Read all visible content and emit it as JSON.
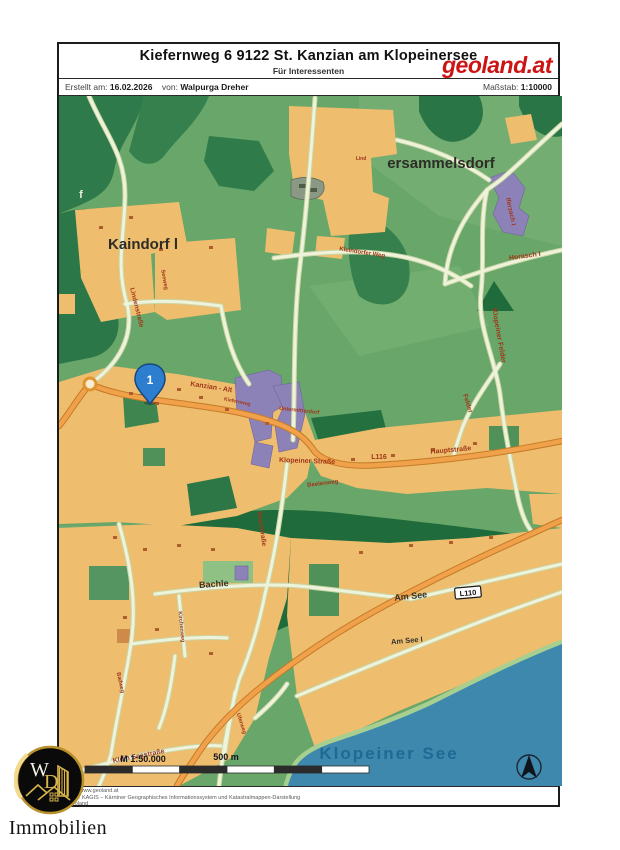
{
  "page": {
    "header": {
      "title": "Kiefernweg 6 9122 St. Kanzian am Klopeinersee",
      "subtitle": "Für Interessenten",
      "logo": "geoland.at",
      "created_label": "Erstellt am:",
      "created_value": "16.02.2026",
      "by_label": "von:",
      "by_value": "Walpurga Dreher",
      "scale_label": "Maßstab:",
      "scale_value": "1:10000"
    },
    "footer": {
      "lines": [
        "https://www.geoland.at",
        "Quelle: KAGIS – Kärntner Geographisches Informationssystem und Katastralmappen-Darstellung",
        "© geoland"
      ]
    },
    "branding": {
      "initial_w": "W",
      "initial_d": "D",
      "name": "Immobilien"
    }
  },
  "map": {
    "marker": {
      "label": "1"
    },
    "shield": "L110",
    "scalebar": {
      "ratio": "M 1:50.000",
      "distance": "500 m"
    },
    "colors": {
      "base_green": "#68a66a",
      "forest_dark": "#1f6b3c",
      "settlement_orange": "#eebd6e",
      "building_purple": "#8d82b8",
      "road_orange": "#f0a14a",
      "road_pale": "#eef3da",
      "lake_blue": "#3e88ae",
      "label_red": "#a0371a",
      "brand_red": "#cc1414",
      "marker_blue": "#2e7ed0"
    },
    "labels": [
      {
        "text": "Lind",
        "x": 302,
        "y": 64,
        "rot": 0,
        "size": 5,
        "cls": "lbl-road"
      },
      {
        "text": "ersammelsdorf",
        "x": 382,
        "y": 72,
        "rot": 0,
        "size": 15,
        "cls": "lbl-place"
      },
      {
        "text": "Kaindorf l",
        "x": 84,
        "y": 153,
        "rot": 0,
        "size": 15,
        "cls": "lbl-place"
      },
      {
        "text": "f",
        "x": 22,
        "y": 102,
        "rot": 0,
        "size": 11,
        "cls": "lbl-light"
      },
      {
        "text": "Kanzian - Alt",
        "x": 152,
        "y": 293,
        "rot": 9,
        "size": 7,
        "cls": "lbl-road"
      },
      {
        "text": "Kiefernweg",
        "x": 178,
        "y": 307,
        "rot": 12,
        "size": 5,
        "cls": "lbl-road"
      },
      {
        "text": "Untermitterdorf",
        "x": 240,
        "y": 316,
        "rot": 6,
        "size": 5.5,
        "cls": "lbl-road"
      },
      {
        "text": "Klopeiner Straße",
        "x": 248,
        "y": 367,
        "rot": 2,
        "size": 7,
        "cls": "lbl-road"
      },
      {
        "text": "L116",
        "x": 320,
        "y": 363,
        "rot": 0,
        "size": 7,
        "cls": "lbl-road"
      },
      {
        "text": "Hauptstraße",
        "x": 392,
        "y": 356,
        "rot": -5,
        "size": 7,
        "cls": "lbl-road"
      },
      {
        "text": "Beelenweg",
        "x": 264,
        "y": 389,
        "rot": -7,
        "size": 6,
        "cls": "lbl-road"
      },
      {
        "text": "Kleindorfer Weg",
        "x": 303,
        "y": 158,
        "rot": 9,
        "size": 6,
        "cls": "lbl-road"
      },
      {
        "text": "Lindenstraße",
        "x": 76,
        "y": 212,
        "rot": 76,
        "size": 6.5,
        "cls": "lbl-road"
      },
      {
        "text": "Seeweg",
        "x": 104,
        "y": 184,
        "rot": 80,
        "size": 5.5,
        "cls": "lbl-road"
      },
      {
        "text": "Iferzach I",
        "x": 450,
        "y": 116,
        "rot": 78,
        "size": 6.5,
        "cls": "lbl-road"
      },
      {
        "text": "Horasch I",
        "x": 466,
        "y": 162,
        "rot": -8,
        "size": 7,
        "cls": "lbl-road"
      },
      {
        "text": "Klopeiner Felder",
        "x": 438,
        "y": 240,
        "rot": 80,
        "size": 7,
        "cls": "lbl-road"
      },
      {
        "text": "Felder",
        "x": 407,
        "y": 308,
        "rot": 72,
        "size": 6.5,
        "cls": "lbl-road"
      },
      {
        "text": "Seenstraße",
        "x": 201,
        "y": 433,
        "rot": 82,
        "size": 6.5,
        "cls": "lbl-road"
      },
      {
        "text": "Bachle",
        "x": 155,
        "y": 491,
        "rot": -4,
        "size": 9,
        "cls": "lbl-place-sm"
      },
      {
        "text": "Am See",
        "x": 352,
        "y": 503,
        "rot": -6,
        "size": 9,
        "cls": "lbl-place-sm"
      },
      {
        "text": "Am See I",
        "x": 348,
        "y": 547,
        "rot": -5,
        "size": 7.5,
        "cls": "lbl-place-sm"
      },
      {
        "text": "Kirchenweg",
        "x": 121,
        "y": 531,
        "rot": 84,
        "size": 5.5,
        "cls": "lbl-road"
      },
      {
        "text": "Badweg",
        "x": 60,
        "y": 587,
        "rot": 78,
        "size": 5.5,
        "cls": "lbl-road"
      },
      {
        "text": "Uferweg",
        "x": 181,
        "y": 628,
        "rot": 72,
        "size": 5.5,
        "cls": "lbl-road"
      },
      {
        "text": "Klein Seestraße",
        "x": 80,
        "y": 662,
        "rot": -11,
        "size": 7,
        "cls": "lbl-road"
      },
      {
        "text": "Klopeiner See",
        "x": 330,
        "y": 663,
        "rot": 0,
        "size": 17,
        "cls": "lbl-water"
      }
    ]
  }
}
